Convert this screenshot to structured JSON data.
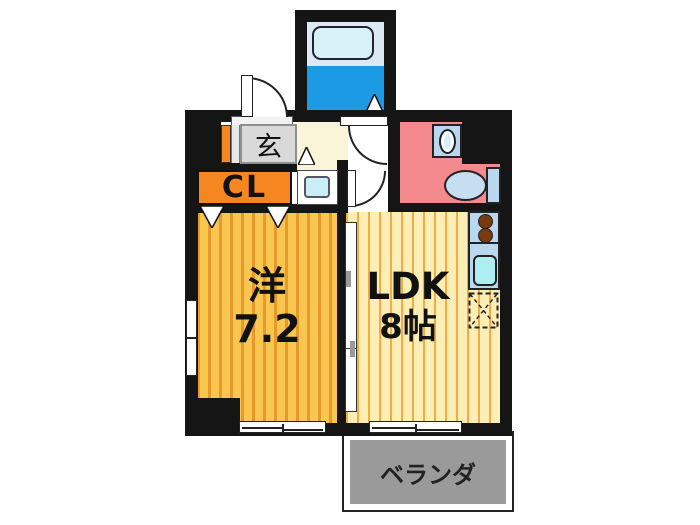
{
  "rooms": {
    "entrance": {
      "label": "玄"
    },
    "closet": {
      "label": "CL"
    },
    "western": {
      "type_label": "洋",
      "size_label": "7.2"
    },
    "ldk": {
      "type_label": "LDK",
      "size_label": "8帖"
    },
    "veranda": {
      "label": "ベランダ"
    }
  },
  "icons": [
    "front-door-icon",
    "bathroom-door-icon",
    "ldk-door-icon",
    "sliding-partition-icon",
    "bathtub-icon",
    "bath-step-triangle-icon",
    "entrance-step-triangle-icon",
    "closet-door-triangle-icon",
    "washing-machine-pan-icon",
    "washbasin-icon",
    "toilet-icon",
    "stove-burner-icon",
    "kitchen-sink-icon",
    "refrigerator-space-icon",
    "window-icon"
  ],
  "colors": {
    "wall": "#151515",
    "western_floor": "#f9c64f",
    "western_stripe": "#e8992b",
    "ldk_floor": "#fdeeb5",
    "ldk_stripe": "#f3ab45",
    "hallway_cream": "#faf5d8",
    "entrance_gray": "#d9d9d9",
    "closet_orange": "#f6861f",
    "washroom_pink": "#f48a8d",
    "bath_floor_blue": "#1d9ae4",
    "bath_wall_blue": "#dce9f4",
    "tub_fill": "#d6f2f8",
    "fixture_blue": "#b9d7ee",
    "sink_cyan": "#aeeef2",
    "pan_cyan": "#c8eef6",
    "burner_brown": "#7a3a10",
    "veranda_gray": "#9a9a9a"
  }
}
